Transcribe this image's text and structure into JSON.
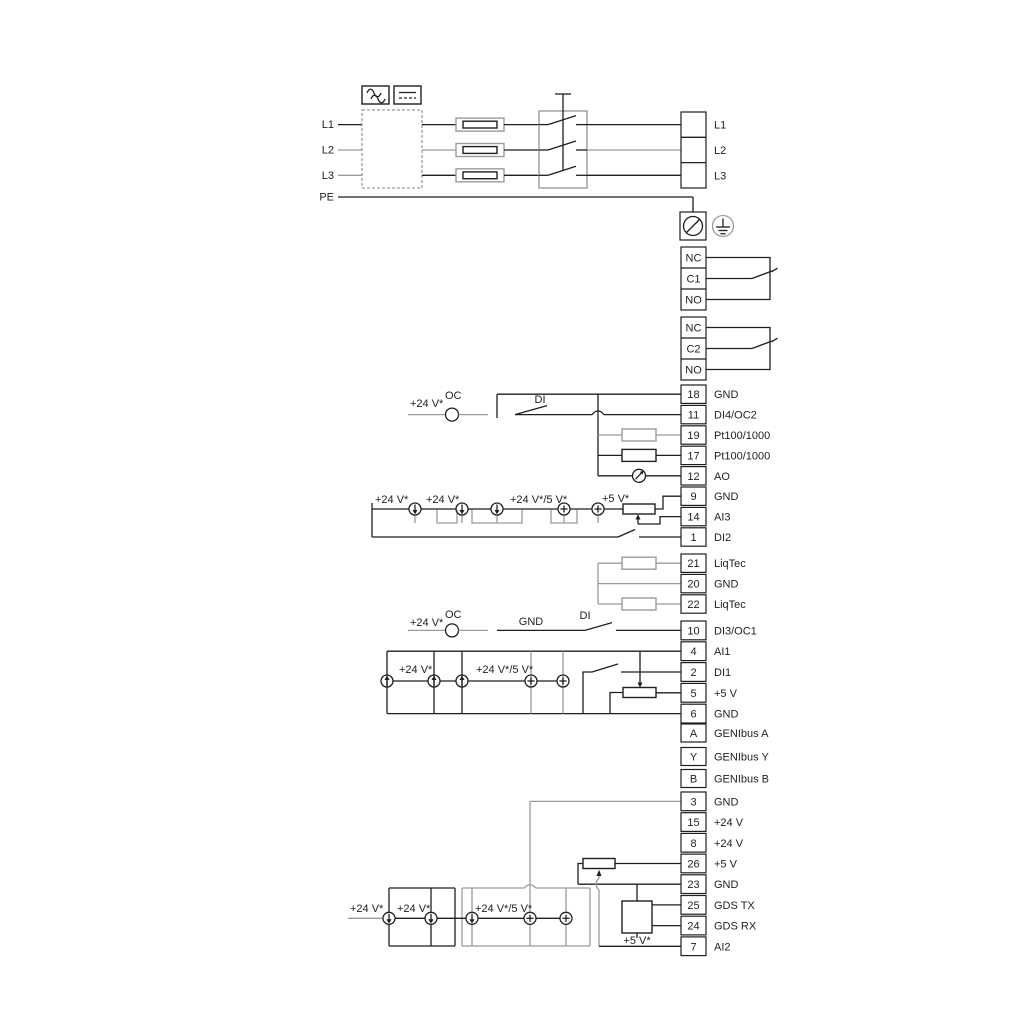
{
  "power": {
    "inputs": [
      "L1",
      "L2",
      "L3",
      "PE"
    ],
    "outputs": [
      "L1",
      "L2",
      "L3"
    ]
  },
  "relay1": [
    "NC",
    "C1",
    "NO"
  ],
  "relay2": [
    "NC",
    "C2",
    "NO"
  ],
  "groups": {
    "c": [
      {
        "num": "18",
        "label": "GND"
      },
      {
        "num": "11",
        "label": "DI4/OC2"
      },
      {
        "num": "19",
        "label": "Pt100/1000"
      },
      {
        "num": "17",
        "label": "Pt100/1000"
      },
      {
        "num": "12",
        "label": "AO"
      },
      {
        "num": "9",
        "label": "GND"
      },
      {
        "num": "14",
        "label": "AI3"
      },
      {
        "num": "1",
        "label": "DI2"
      }
    ],
    "d": [
      {
        "num": "21",
        "label": "LiqTec"
      },
      {
        "num": "20",
        "label": "GND"
      },
      {
        "num": "22",
        "label": "LiqTec"
      }
    ],
    "e": [
      {
        "num": "10",
        "label": "DI3/OC1"
      },
      {
        "num": "4",
        "label": "AI1"
      },
      {
        "num": "2",
        "label": "DI1"
      },
      {
        "num": "5",
        "label": "+5 V"
      },
      {
        "num": "6",
        "label": "GND"
      },
      {
        "num": "A",
        "label": "GENIbus A"
      },
      {
        "num": "Y",
        "label": "GENIbus Y"
      },
      {
        "num": "B",
        "label": "GENIbus B"
      }
    ],
    "f": [
      {
        "num": "3",
        "label": "GND"
      },
      {
        "num": "15",
        "label": "+24 V"
      },
      {
        "num": "8",
        "label": "+24 V"
      },
      {
        "num": "26",
        "label": "+5 V"
      },
      {
        "num": "23",
        "label": "GND"
      },
      {
        "num": "25",
        "label": "GDS TX"
      },
      {
        "num": "24",
        "label": "GDS RX"
      },
      {
        "num": "7",
        "label": "AI2"
      }
    ]
  },
  "labels": {
    "v24": "+24 V*",
    "oc": "OC",
    "di": "DI",
    "gnd": "GND",
    "v24_5": "+24 V*/5 V*",
    "v5": "+5 V*"
  },
  "colors": {
    "wire_black": "#1f1f1f",
    "wire_gray": "#9b9b9b"
  }
}
